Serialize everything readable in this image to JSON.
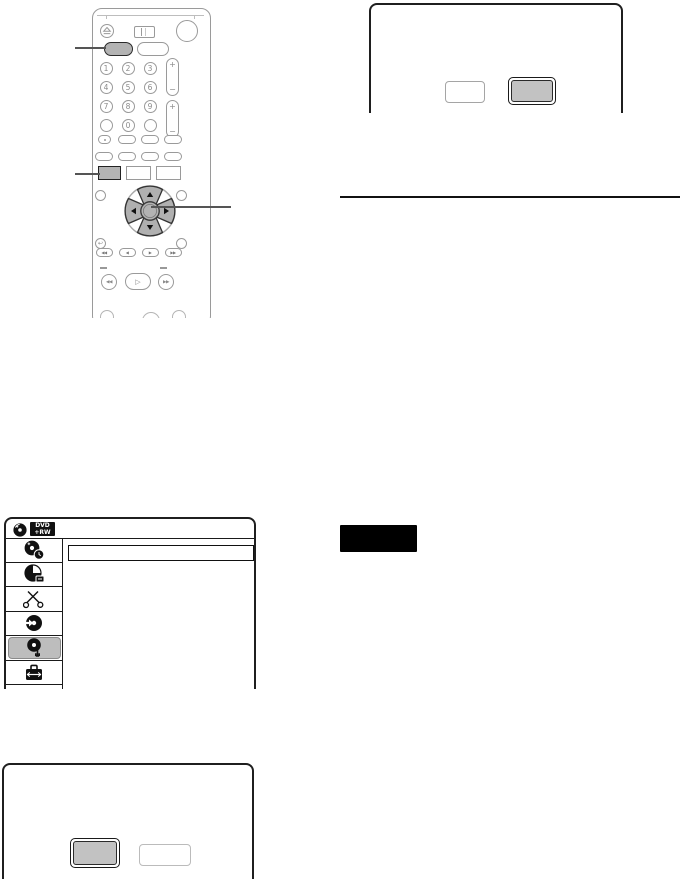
{
  "page": {
    "background": "#ffffff"
  },
  "colors": {
    "button_highlight": "#b3b3b3",
    "menu_highlight": "#bdbdbd",
    "screen_border": "#1f1f1f",
    "remote_outline": "#9a9a9a",
    "callout_line": "#555555",
    "note_box": "#000000"
  },
  "remote": {
    "digits": [
      "1",
      "2",
      "3",
      "4",
      "5",
      "6",
      "7",
      "8",
      "9",
      "0"
    ],
    "rocker": {
      "plus": "+",
      "minus": "−"
    },
    "transport_marks": [
      "◀◀",
      "◀",
      "▶",
      "▶▶"
    ],
    "scan_back": "◀◀",
    "play": "▷",
    "scan_forward": "▶▶",
    "return_glyph": "↩",
    "icons": [
      "eject-icon",
      "tray-open-icon",
      "power-icon",
      "dpad-up-arrow-icon",
      "dpad-right-arrow-icon",
      "dpad-down-arrow-icon",
      "dpad-left-arrow-icon",
      "enter-button-icon",
      "return-icon"
    ]
  },
  "menu_screen": {
    "disc_type_badge": {
      "line1": "DVD",
      "line2": "+RW"
    },
    "header_icon": "dvd-disc-icon",
    "sidebar_items": [
      {
        "icon": "title-list-icon",
        "selected": false
      },
      {
        "icon": "timer-icon",
        "selected": false
      },
      {
        "icon": "edit-scissors-icon",
        "selected": false
      },
      {
        "icon": "dubbing-icon",
        "selected": false
      },
      {
        "icon": "disc-setup-icon",
        "selected": true
      },
      {
        "icon": "setup-toolbox-icon",
        "selected": false
      }
    ]
  },
  "dialog_top_right": {
    "buttons": [
      {
        "label": "",
        "selected": false
      },
      {
        "label": "",
        "selected": true
      }
    ]
  },
  "dialog_bottom_left": {
    "buttons": [
      {
        "label": "",
        "selected": true
      },
      {
        "label": "",
        "selected": false
      }
    ]
  },
  "note_box": {
    "label": ""
  }
}
